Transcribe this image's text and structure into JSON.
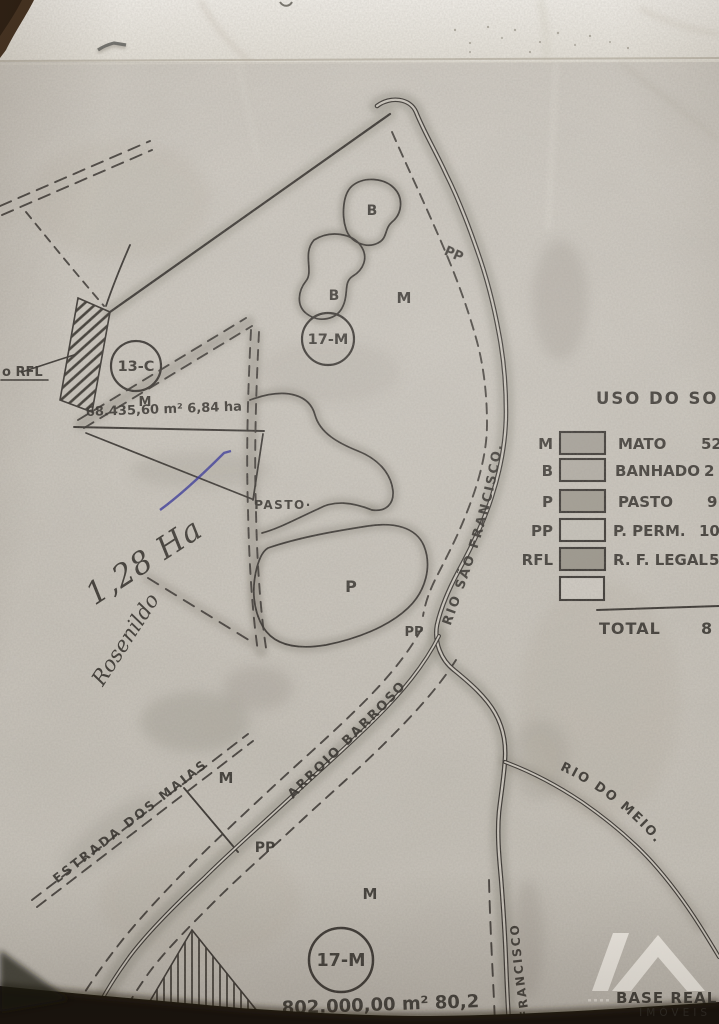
{
  "legend": {
    "title": "USO DO SOLO",
    "rows": [
      {
        "key": "M",
        "label": "MATO",
        "value": "52,"
      },
      {
        "key": "B",
        "label": "BANHADO",
        "value": "2"
      },
      {
        "key": "P",
        "label": "PASTO",
        "value": "9"
      },
      {
        "key": "PP",
        "label": "P. PERM.",
        "value": "10"
      },
      {
        "key": "RFL",
        "label": "R. F. LEGAL",
        "value": "5"
      },
      {
        "key": "",
        "label": "",
        "value": ""
      }
    ],
    "total_label": "TOTAL",
    "total_value": "8"
  },
  "parcels": {
    "c13": {
      "id": "13-C",
      "zone": "M",
      "area": "68.435,60 m²  6,84 ha"
    },
    "m17_top": {
      "id": "17-M"
    },
    "m17_bottom": {
      "id": "17-M",
      "area": "802.000,00 m²   80,2"
    }
  },
  "zone_labels": {
    "b_upper": "B",
    "b_lower": "B",
    "m_upper": "M",
    "m_mid": "M",
    "m_lower": "M",
    "p": "P",
    "pasto": "PASTO·",
    "pp_upper": "PP",
    "pp_mid": "PP",
    "pp_lower": "PP",
    "rfl_callout": "o RFL"
  },
  "waterways": {
    "rio_sao_francisco": "RIO SÃO FRANCISCO.",
    "arroio_barroso": "ARROIO BARROSO",
    "rio_do_meio": "RIO DO MEIO.",
    "rio_francisco_lower": "FRANCISCO"
  },
  "roads": {
    "estrada_dos_maias": "ESTRADA DOS MAIAS"
  },
  "handwriting": {
    "area": "1,28 Ha",
    "name": "Rosenildo"
  },
  "watermark": {
    "name": "BASE REAL",
    "subtitle": "IMÓVEIS"
  },
  "colors": {
    "ink": "#383430",
    "pen_blue": "#2c2c99",
    "paper": "#cbc6bd",
    "photo_edge": "#15100b"
  }
}
